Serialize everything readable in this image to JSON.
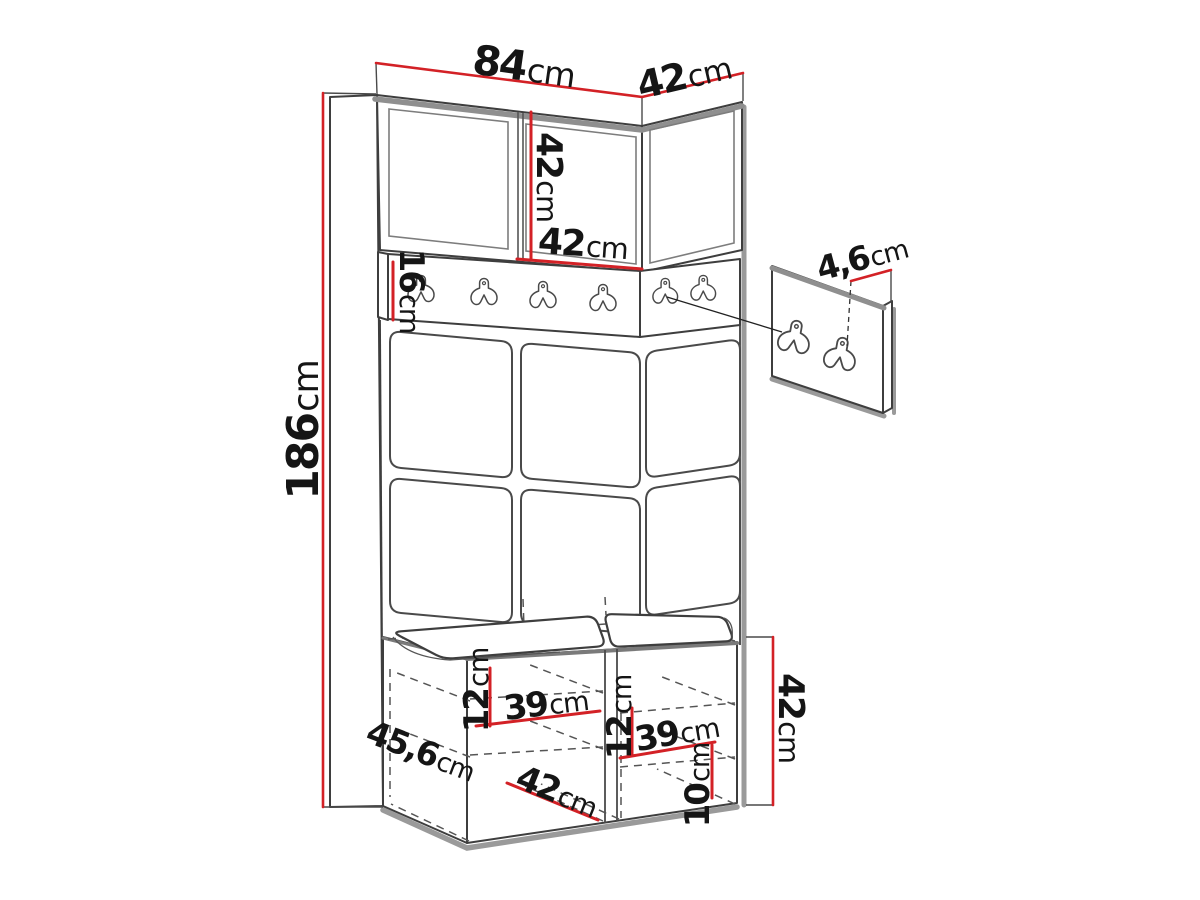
{
  "diagram": {
    "title": "hallway wardrobe set dimension diagram",
    "accent_color": "#d32126",
    "line_color": "#3e3e3e",
    "shadow_color": "#9a9a9a",
    "rail_hook_count": 6,
    "panel_hook_count": 2,
    "dimensions": {
      "total_height": {
        "value": "186",
        "unit": "cm"
      },
      "top_width": {
        "value": "84",
        "unit": "cm"
      },
      "top_depth": {
        "value": "42",
        "unit": "cm"
      },
      "upper_cabinet_height": {
        "value": "42",
        "unit": "cm"
      },
      "upper_door_width": {
        "value": "42",
        "unit": "cm"
      },
      "hook_rail_height": {
        "value": "16",
        "unit": "cm"
      },
      "wall_panel_thickness": {
        "value": "4,6",
        "unit": "cm"
      },
      "bench_depth": {
        "value": "45,6",
        "unit": "cm"
      },
      "bench_height": {
        "value": "42",
        "unit": "cm"
      },
      "bench_left_shelf_drop": {
        "value": "12",
        "unit": "cm"
      },
      "bench_left_shelf_width": {
        "value": "39",
        "unit": "cm"
      },
      "bench_inner_depth": {
        "value": "42",
        "unit": "cm"
      },
      "bench_right_shelf_drop": {
        "value": "12",
        "unit": "cm"
      },
      "bench_right_shelf_width": {
        "value": "39",
        "unit": "cm"
      },
      "bench_bottom_clearance": {
        "value": "10",
        "unit": "cm"
      }
    }
  }
}
